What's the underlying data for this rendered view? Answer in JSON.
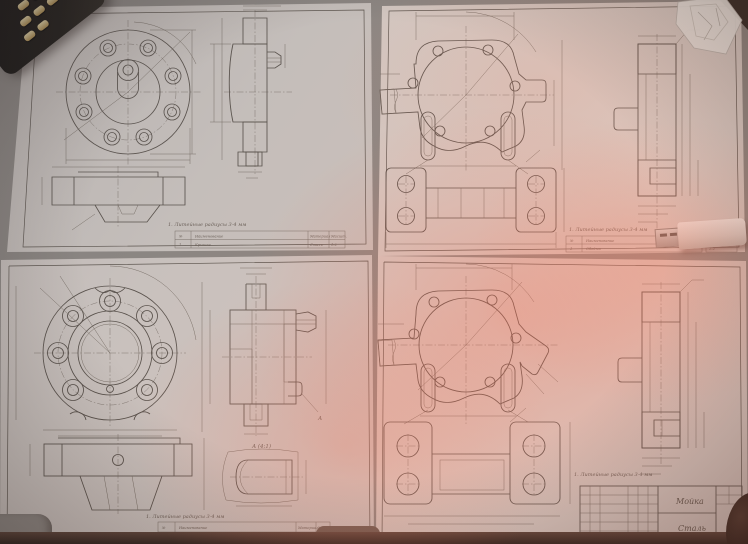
{
  "colors": {
    "desk": "#8d8884",
    "desk_edge": "#2d211c",
    "paper_top_left": "#cbc5c1",
    "paper_top_right": "#d8cec8",
    "paper_bottom_left": "#cfc8c4",
    "paper_bottom_right": "#d9cdc7",
    "drawing_line": "#57504a",
    "pink_glow": "#f86e54",
    "phone_body": "#15120f",
    "phone_keys": "#c8a868",
    "usb_body": "#e8e6e1",
    "usb_metal": "#b9b9b6"
  },
  "sheets": {
    "top_left": {
      "note": "1. Литейные радиусы 3-4 мм",
      "table": {
        "headers": [
          "№",
          "Наименование",
          "Материал",
          "Масшт."
        ],
        "row": [
          "1",
          "Крышка",
          "Сталь",
          "1:2"
        ]
      }
    },
    "top_right": {
      "note": "1. Литейные радиусы 3-4 мм",
      "table": {
        "headers": [
          "№",
          "Наименование",
          "Материал",
          "Масшт."
        ],
        "row": [
          "1",
          "Обойма",
          "Сталь",
          "1:2"
        ]
      }
    },
    "bottom_left": {
      "note": "1. Литейные радиусы 3-4 мм",
      "detail_label": "А (4:1)",
      "detail_arrow": "А",
      "table": {
        "headers": [
          "№",
          "Наименование",
          "Материал",
          "Масшт."
        ],
        "row": [
          "1",
          "Крышка",
          "Сталь",
          "1:2"
        ]
      }
    },
    "bottom_right": {
      "note": "1. Литейные радиусы 3-4 мм",
      "title_block": {
        "name": "Мойка",
        "material": "Сталь"
      }
    }
  },
  "objects": {
    "phone": "phone-keypad",
    "usb": "usb-flash-drive",
    "plastic": "crumpled-plastic",
    "desk_edge": "desk-edge",
    "finger": "finger-shadow"
  }
}
